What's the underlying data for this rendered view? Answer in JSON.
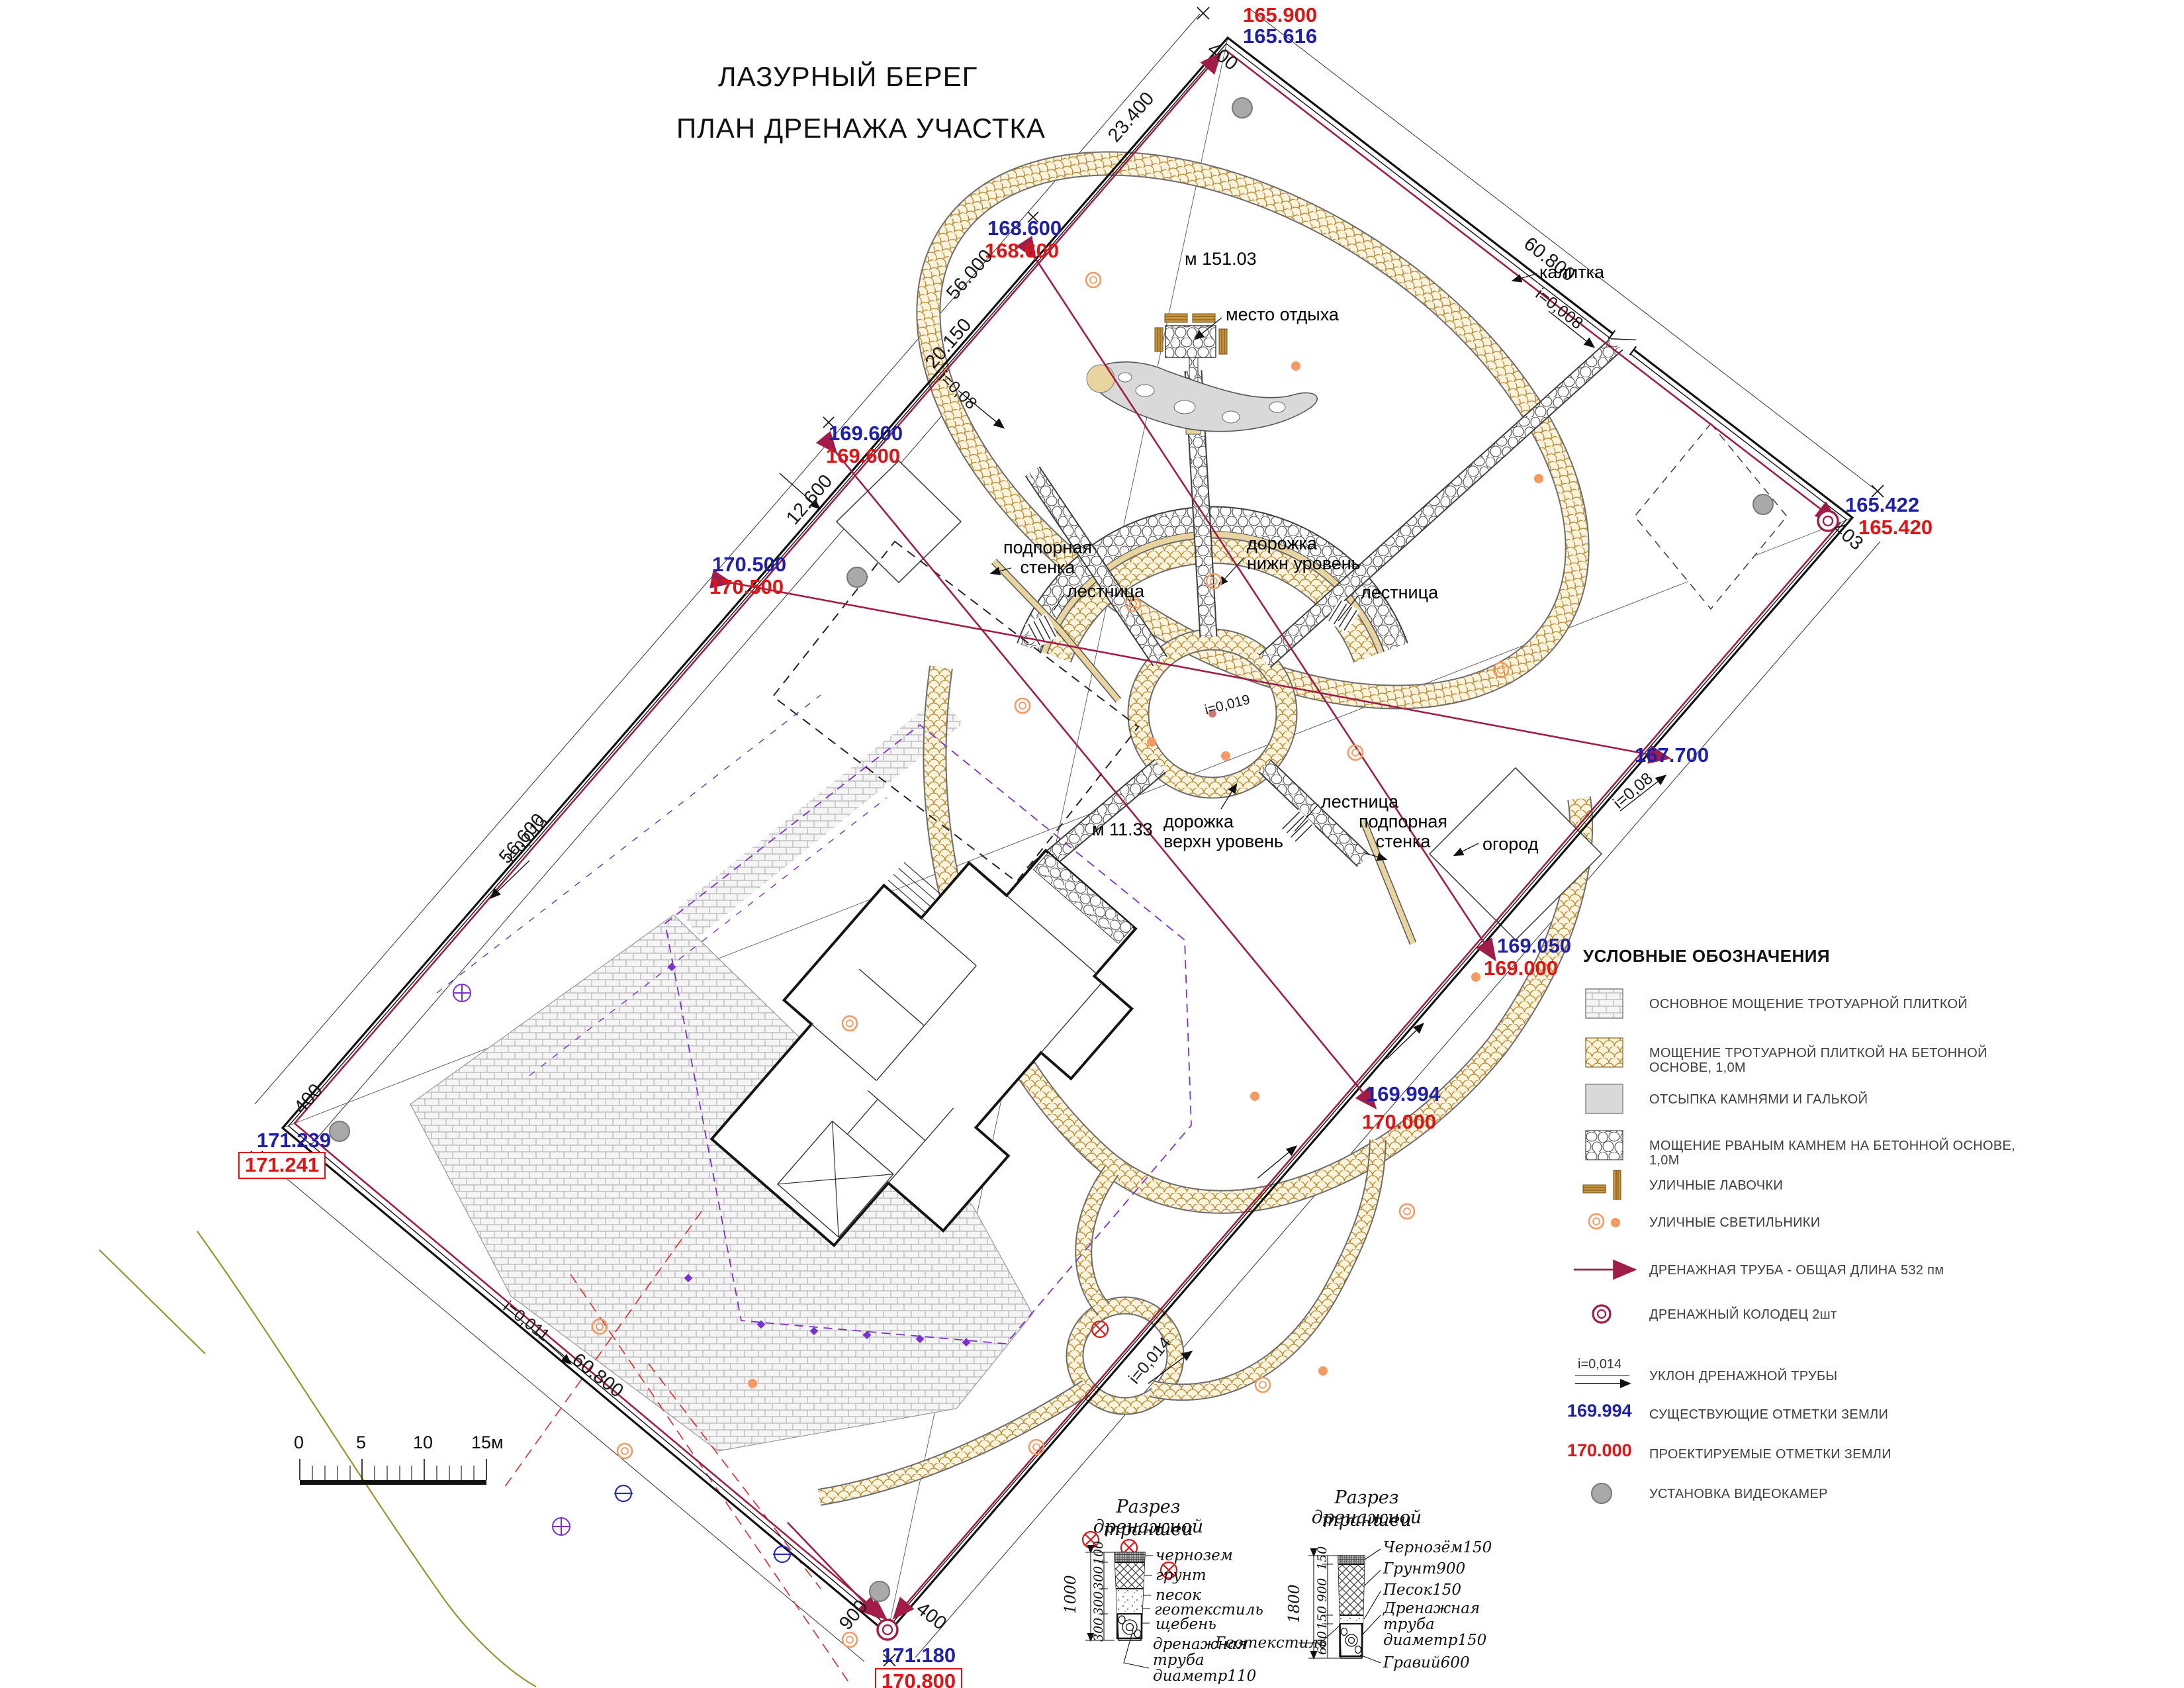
{
  "title": {
    "line1": "ЛАЗУРНЫЙ БЕРЕГ",
    "line2": "ПЛАН ДРЕНАЖА УЧАСТКА"
  },
  "marks": {
    "top_red": "165.900",
    "top_blue": "165.616",
    "m1_blue": "168.600",
    "m1_red": "168.600",
    "m2_blue": "169.600",
    "m2_red": "169.600",
    "m3_blue": "170.500",
    "m3_red": "170.500",
    "right_blue": "165.422",
    "right_red": "165.420",
    "mid_blue": "167.700",
    "m6_blue": "169.050",
    "m6_red": "169.000",
    "m7_blue": "169.994",
    "m7_red": "170.000",
    "left_blue": "171.239",
    "left_red": "171.241",
    "bottom_blue": "171.180",
    "bottom_red": "170.800"
  },
  "dims": {
    "d1": "23.400",
    "d2": "56.000",
    "d3": "20.150",
    "d4": "12.600",
    "d5": "56.600",
    "d6": "60.800",
    "d7": "60.800",
    "d8": "400",
    "d9": "403",
    "d10": "400",
    "d11": "900",
    "d12": "400"
  },
  "slopes": {
    "s1": "i=0,008",
    "s2": "i=0,08",
    "s3": "i=0,08",
    "s4": "i=0,013",
    "s5": "i=0,011",
    "s6": "i=0,014",
    "s7": "i=0,019"
  },
  "features": {
    "oval_len": "м 151.03",
    "rest": "место отдыха",
    "gate": "калитка",
    "wall1": "подпорная\nстенка",
    "path_low": "дорожка\nнижн уровень",
    "stairs1": "лестница",
    "stairs2": "лестница",
    "path_up": "дорожка\nверхн уровень",
    "len2": "м 11.33",
    "stairs3": "лестница",
    "wall2": "подпорная\nстенка",
    "garden": "огород"
  },
  "legend": {
    "title": "УСЛОВНЫЕ ОБОЗНАЧЕНИЯ",
    "items": [
      "ОСНОВНОЕ МОЩЕНИЕ ТРОТУАРНОЙ ПЛИТКОЙ",
      "МОЩЕНИЕ ТРОТУАРНОЙ ПЛИТКОЙ НА БЕТОННОЙ ОСНОВЕ, 1,0М",
      "ОТСЫПКА КАМНЯМИ И ГАЛЬКОЙ",
      "МОЩЕНИЕ РВАНЫМ КАМНЕМ НА БЕТОННОЙ ОСНОВЕ, 1,0М",
      "УЛИЧНЫЕ ЛАВОЧКИ",
      "УЛИЧНЫЕ СВЕТИЛЬНИКИ",
      "ДРЕНАЖНАЯ ТРУБА - ОБЩАЯ ДЛИНА 532 пм",
      "ДРЕНАЖНЫЙ КОЛОДЕЦ 2шт",
      "УКЛОН ДРЕНАЖНОЙ ТРУБЫ",
      "СУЩЕСТВУЮЩИЕ ОТМЕТКИ ЗЕМЛИ",
      "ПРОЕКТИРУЕМЫЕ ОТМЕТКИ ЗЕМЛИ",
      "УСТАНОВКА ВИДЕОКАМЕР"
    ],
    "slope_value": "i=0,014",
    "blue_value": "169.994",
    "red_value": "170.000"
  },
  "scalebar": {
    "t0": "0",
    "t1": "5",
    "t2": "10",
    "t3": "15м"
  },
  "sections": {
    "left": {
      "title_l1": "Разрез дренажной",
      "title_l2": "траншеи",
      "total": "1000",
      "seg1": "100",
      "seg2": "300",
      "seg3": "300",
      "seg4": "300",
      "l1": "чернозем",
      "l2": "грунт",
      "l3": "песок",
      "l4": "геотекстиль",
      "l5": "щебень",
      "p1": "дренажная",
      "p2": "труба",
      "p3": "диаметр110"
    },
    "right": {
      "title_l1": "Разрез дренажной",
      "title_l2": "траншеи",
      "total": "1800",
      "seg1": "150",
      "seg2": "900",
      "seg3": "150",
      "seg4": "600",
      "l1": "Чернозём150",
      "l2": "Грунт900",
      "l3": "Песок150",
      "p1": "Дренажная",
      "p2": "труба",
      "p3": "диаметр150",
      "geo": "Геотекстиль",
      "gravel": "Гравий600"
    }
  }
}
